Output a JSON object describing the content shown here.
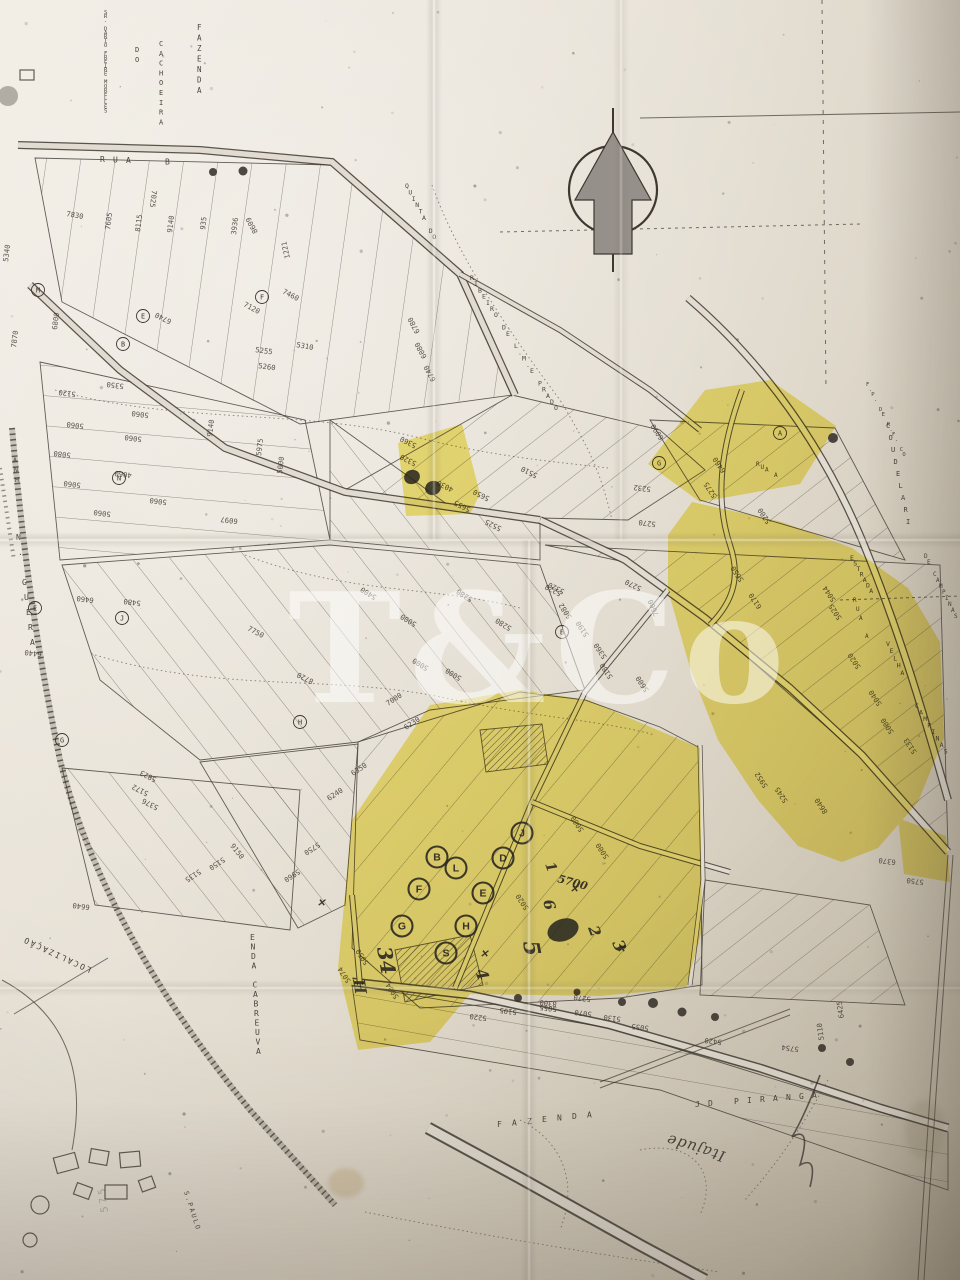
{
  "watermark": {
    "text": "T&Co"
  },
  "map_labels": [
    [
      "FAZENDA",
      197,
      30,
      0,
      7.5,
      0,
      "",
      0,
      10.5
    ],
    [
      "CACHOEIRA",
      159,
      46,
      0,
      7,
      0,
      "",
      0,
      9.8
    ],
    [
      "DO",
      135,
      52,
      0,
      7,
      0,
      "",
      0,
      9.8
    ],
    [
      "SR. DARIO FREIRE MORELLES",
      104,
      14,
      0,
      5.5,
      0,
      "",
      0,
      4.1
    ],
    [
      "RUA  B",
      100,
      162,
      0,
      8,
      0,
      "",
      13,
      0.5
    ],
    [
      "QUINTA DO",
      405,
      188,
      0,
      6.5,
      0,
      "",
      3.4,
      6.4
    ],
    [
      "RIBEIRO DE L.M.E PRADO",
      470,
      280,
      0,
      6.5,
      0,
      "",
      4,
      6.2
    ],
    [
      "ESTRADA",
      850,
      560,
      0,
      6.5,
      0,
      "",
      3.2,
      5.5
    ],
    [
      "VELHA",
      886,
      646,
      0,
      6.5,
      0,
      "",
      3.6,
      7.2
    ],
    [
      "CAMPINAS",
      915,
      708,
      0,
      6.5,
      0,
      "",
      4.1,
      6.5
    ],
    [
      "RUA A",
      853,
      602,
      0,
      6,
      0,
      "",
      3,
      9
    ],
    [
      "RUA A",
      756,
      466,
      0,
      6,
      0,
      "",
      4.5,
      2.8
    ],
    [
      "COUDELARI",
      886,
      428,
      0,
      7,
      0,
      "",
      2.5,
      12
    ],
    [
      "DE CAMPINAS",
      924,
      558,
      0,
      6,
      0,
      "",
      3,
      6
    ],
    [
      "F.P. DE R.F. CO",
      866,
      386,
      0,
      5.5,
      0,
      "",
      2.6,
      5
    ],
    [
      "N. GUERA",
      16,
      540,
      0,
      8,
      0,
      "",
      2,
      15
    ],
    [
      "ANH",
      13,
      462,
      0,
      6.5,
      0,
      "",
      1,
      10
    ],
    [
      "ENDA CABREUVA",
      250,
      940,
      0,
      8,
      0,
      "",
      0.5,
      9.5
    ],
    [
      "FAZENDA",
      497,
      1127,
      0,
      8,
      0,
      "",
      15,
      -1.6
    ],
    [
      "JD PIRANGA",
      695,
      1107,
      0,
      8,
      0,
      "",
      13,
      -1
    ],
    [
      "LOCALIZAÇÃO",
      92,
      968,
      205,
      8,
      2,
      "",
      null,
      null
    ],
    [
      "S.PAULO",
      184,
      1192,
      72,
      6.5,
      2,
      "",
      null,
      null
    ],
    [
      "Itajude",
      726,
      1152,
      197,
      15,
      1,
      "hand",
      null,
      null
    ],
    [
      "575",
      108,
      1212,
      262,
      10,
      3,
      "bleed",
      null,
      null
    ]
  ],
  "lots": [
    [
      "7025",
      152,
      190,
      97
    ],
    [
      "7830",
      66,
      216,
      10
    ],
    [
      "7605",
      110,
      230,
      277
    ],
    [
      "8115",
      140,
      232,
      277
    ],
    [
      "9140",
      172,
      233,
      277
    ],
    [
      "935",
      205,
      230,
      277
    ],
    [
      "3936",
      236,
      235,
      277
    ],
    [
      "8609",
      258,
      232,
      242
    ],
    [
      "1221",
      290,
      258,
      257
    ],
    [
      "5340",
      8,
      262,
      277
    ],
    [
      "7120",
      243,
      306,
      28
    ],
    [
      "7460",
      282,
      293,
      28
    ],
    [
      "6740",
      172,
      320,
      207
    ],
    [
      "6800",
      57,
      330,
      277
    ],
    [
      "7870",
      16,
      348,
      277
    ],
    [
      "6780",
      420,
      332,
      242
    ],
    [
      "6080",
      427,
      357,
      242
    ],
    [
      "6740",
      436,
      380,
      242
    ],
    [
      "5310",
      296,
      347,
      10
    ],
    [
      "5255",
      255,
      352,
      8
    ],
    [
      "5260",
      258,
      368,
      8
    ],
    [
      "5120",
      76,
      392,
      187
    ],
    [
      "5350",
      124,
      384,
      187
    ],
    [
      "5060",
      84,
      424,
      187
    ],
    [
      "5060",
      149,
      413,
      187
    ],
    [
      "5080",
      71,
      453,
      187
    ],
    [
      "5060",
      142,
      437,
      187
    ],
    [
      "4060",
      132,
      473,
      187
    ],
    [
      "5060",
      81,
      483,
      187
    ],
    [
      "5060",
      167,
      500,
      187
    ],
    [
      "5060",
      111,
      512,
      187
    ],
    [
      "9140",
      212,
      437,
      277
    ],
    [
      "5975",
      261,
      456,
      277
    ],
    [
      "5000",
      282,
      474,
      277
    ],
    [
      "6097",
      238,
      519,
      187
    ],
    [
      "6460",
      94,
      598,
      187
    ],
    [
      "5480",
      141,
      601,
      187
    ],
    [
      "6440",
      42,
      652,
      187
    ],
    [
      "7750",
      247,
      630,
      28
    ],
    [
      "5823",
      157,
      778,
      207
    ],
    [
      "5172",
      149,
      792,
      207
    ],
    [
      "5376",
      159,
      806,
      207
    ],
    [
      "9150",
      230,
      846,
      52
    ],
    [
      "5750",
      318,
      842,
      147
    ],
    [
      "6240",
      329,
      801,
      327
    ],
    [
      "6350",
      353,
      776,
      327
    ],
    [
      "7000",
      388,
      706,
      327
    ],
    [
      "6230",
      406,
      730,
      327
    ],
    [
      "5400",
      377,
      596,
      212
    ],
    [
      "5000",
      417,
      623,
      212
    ],
    [
      "5280",
      473,
      598,
      212
    ],
    [
      "5280",
      512,
      627,
      212
    ],
    [
      "5220",
      562,
      592,
      207
    ],
    [
      "8720",
      314,
      680,
      207
    ],
    [
      "5000",
      429,
      667,
      212
    ],
    [
      "5000",
      462,
      677,
      212
    ],
    [
      "5320",
      565,
      590,
      207
    ],
    [
      "5082",
      572,
      617,
      237
    ],
    [
      "5190",
      589,
      635,
      237
    ],
    [
      "5360",
      607,
      657,
      237
    ],
    [
      "5180",
      613,
      677,
      237
    ],
    [
      "7600",
      659,
      615,
      247
    ],
    [
      "5600",
      649,
      690,
      237
    ],
    [
      "5270",
      642,
      587,
      207
    ],
    [
      "6090",
      664,
      438,
      237
    ],
    [
      "6460",
      726,
      471,
      237
    ],
    [
      "5275",
      717,
      496,
      237
    ],
    [
      "5200",
      771,
      522,
      237
    ],
    [
      "5650",
      744,
      580,
      237
    ],
    [
      "6170",
      762,
      607,
      237
    ],
    [
      "5044",
      836,
      600,
      237
    ],
    [
      "5025",
      842,
      618,
      237
    ],
    [
      "5232",
      651,
      487,
      187
    ],
    [
      "5270",
      656,
      522,
      187
    ],
    [
      "5020",
      861,
      667,
      237
    ],
    [
      "5040",
      882,
      704,
      237
    ],
    [
      "5000",
      894,
      732,
      237
    ],
    [
      "5133",
      917,
      752,
      237
    ],
    [
      "5952",
      768,
      786,
      237
    ],
    [
      "5245",
      788,
      801,
      237
    ],
    [
      "8640",
      828,
      812,
      237
    ],
    [
      "6370",
      896,
      860,
      187
    ],
    [
      "5750",
      924,
      880,
      187
    ],
    [
      "5360",
      417,
      444,
      207
    ],
    [
      "5320",
      417,
      462,
      207
    ],
    [
      "4030",
      454,
      488,
      207
    ],
    [
      "5650",
      490,
      497,
      207
    ],
    [
      "5655",
      471,
      508,
      207
    ],
    [
      "5510",
      538,
      474,
      207
    ],
    [
      "5525",
      502,
      527,
      207
    ],
    [
      "5000",
      584,
      830,
      237
    ],
    [
      "5000",
      609,
      857,
      237
    ],
    [
      "5020",
      529,
      908,
      237
    ],
    [
      "5004",
      399,
      997,
      237
    ],
    [
      "5074",
      351,
      981,
      237
    ],
    [
      "5050",
      369,
      963,
      237
    ],
    [
      "5270",
      591,
      997,
      187
    ],
    [
      "8300",
      557,
      1002,
      187
    ],
    [
      "5220",
      487,
      1016,
      187
    ],
    [
      "5105",
      517,
      1010,
      187
    ],
    [
      "5055",
      557,
      1007,
      187
    ],
    [
      "5070",
      592,
      1012,
      187
    ],
    [
      "5130",
      621,
      1017,
      187
    ],
    [
      "5055",
      649,
      1026,
      187
    ],
    [
      "5420",
      722,
      1040,
      187
    ],
    [
      "5110",
      824,
      1040,
      262
    ],
    [
      "5754",
      799,
      1047,
      187
    ],
    [
      "6425",
      844,
      1018,
      262
    ],
    [
      "6640",
      90,
      905,
      187
    ],
    [
      "5135",
      199,
      869,
      147
    ],
    [
      "5150",
      223,
      857,
      147
    ],
    [
      "5960",
      298,
      869,
      147
    ]
  ],
  "markers": [
    [
      "M",
      38,
      290
    ],
    [
      "F",
      262,
      297
    ],
    [
      "E",
      143,
      316
    ],
    [
      "B",
      123,
      344
    ],
    [
      "N",
      119,
      478
    ],
    [
      "H",
      300,
      722
    ],
    [
      "G",
      62,
      740
    ],
    [
      "J",
      122,
      618
    ],
    [
      "A",
      780,
      433
    ],
    [
      "G",
      659,
      463
    ],
    [
      "B",
      562,
      632
    ],
    [
      "E",
      35,
      608
    ]
  ],
  "hand_marks": {
    "circled": [
      [
        "B",
        437,
        857
      ],
      [
        "L",
        456,
        868
      ],
      [
        "F",
        419,
        889
      ],
      [
        "E",
        483,
        893
      ],
      [
        "D",
        503,
        858
      ],
      [
        "J",
        522,
        833
      ],
      [
        "G",
        402,
        926
      ],
      [
        "H",
        466,
        926
      ],
      [
        "S",
        446,
        953
      ]
    ],
    "numbers": [
      [
        "34",
        377,
        948,
        80,
        20
      ],
      [
        "H",
        353,
        980,
        80,
        16
      ],
      [
        "5",
        523,
        942,
        80,
        22
      ],
      [
        "6",
        543,
        901,
        75,
        15
      ],
      [
        "1",
        545,
        864,
        70,
        14
      ],
      [
        "2",
        588,
        928,
        70,
        15
      ],
      [
        "3",
        612,
        943,
        65,
        16
      ],
      [
        "4",
        475,
        971,
        70,
        16
      ],
      [
        "5700",
        557,
        882,
        15,
        11
      ]
    ],
    "crosses": [
      [
        570,
        892
      ],
      [
        617,
        952
      ],
      [
        480,
        957
      ],
      [
        317,
        906
      ]
    ],
    "solid": [
      [
        563,
        930,
        16,
        11
      ],
      [
        412,
        477,
        8,
        7
      ],
      [
        433,
        488,
        8,
        7
      ]
    ]
  },
  "ink_dots": [
    [
      213,
      172,
      4
    ],
    [
      243,
      171,
      4.5
    ],
    [
      833,
      438,
      5
    ],
    [
      518,
      998,
      4
    ],
    [
      653,
      1003,
      5
    ],
    [
      622,
      1002,
      4
    ],
    [
      682,
      1012,
      4.5
    ],
    [
      715,
      1017,
      4
    ],
    [
      822,
      1048,
      4
    ],
    [
      850,
      1062,
      4
    ],
    [
      577,
      992,
      3.5
    ]
  ]
}
